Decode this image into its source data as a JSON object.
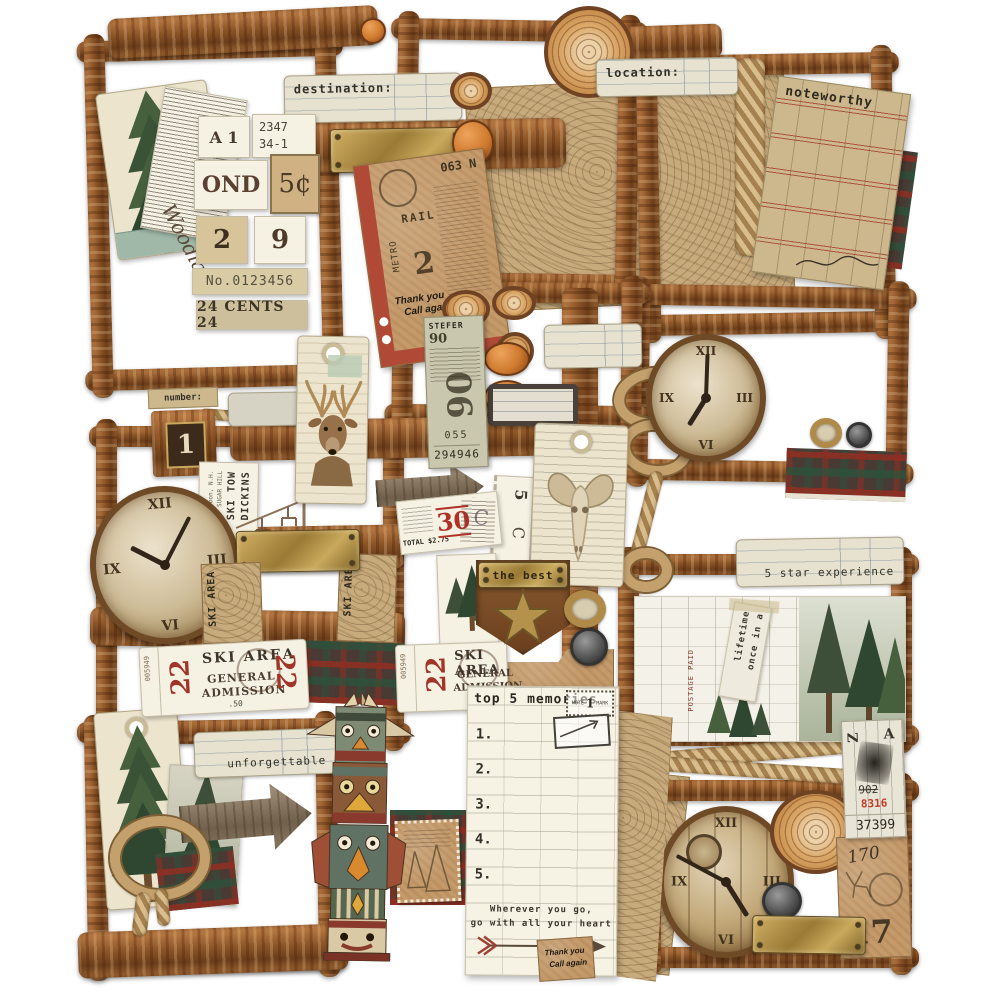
{
  "colors": {
    "wood": "#8a5328",
    "kraft": "#c49a6a",
    "brass": "#b08d3e",
    "accent_red": "#a83a28",
    "teal": "#5f7264",
    "cream": "#ece4cc"
  },
  "labels": {
    "destination": "destination:",
    "location": "location:",
    "number": "number:",
    "noteworthy": "noteworthy",
    "five_star": "5 star experience",
    "unforgettable": "unforgettable",
    "the_best": "the best",
    "once_line1": "once in a",
    "once_line2": "lifetime",
    "postage": "POSTAGE PAID",
    "block_numeral": "1",
    "script_word": "Woodland"
  },
  "stamps": {
    "a1": "A 1",
    "route_line1": "2347",
    "route_line2": "34-1",
    "ond": "OND",
    "five_cents": "5¢",
    "numeral_left": "2",
    "numeral_right": "9",
    "serial": "No.0123456",
    "cents": "24 CENTS 24"
  },
  "tickets": {
    "stefer": {
      "head": "STEFER",
      "sub": "90",
      "big": "90",
      "num": "055",
      "serial": "294946"
    },
    "rail": {
      "top": "063 N",
      "rail": "RAIL",
      "metro": "METRO",
      "big": "2",
      "thanks1": "Thank you",
      "thanks2": "Call again",
      "num": "033"
    },
    "red30": {
      "day": "30",
      "total": "TOTAL $2.75",
      "over": "C"
    },
    "strip5c": {
      "n": "5",
      "c": "C"
    },
    "ski": {
      "title": "SKI AREA",
      "big": "22",
      "line1": "GENERAL",
      "line2": "ADMISSION",
      "price": ".50",
      "serial": "005949"
    },
    "dickins": {
      "line1": "DICKINS",
      "line2": "SKI TOW",
      "line3": "SUGAR HILL",
      "line4": "Lisbon, N.H."
    },
    "ski_map": "SKI AREA",
    "za": {
      "z": "Z",
      "a": "A",
      "num": "902",
      "red": "8316",
      "serial": "37399"
    },
    "k17": {
      "script": "170",
      "big": "17"
    },
    "thanks1": "Thank you",
    "thanks2": "Call again"
  },
  "memo": {
    "title": "top 5 memories",
    "stamp_left": "NOTE",
    "stamp_num": "1",
    "stamp_right": "MARK",
    "rows": [
      "1.",
      "2.",
      "3.",
      "4.",
      "5."
    ],
    "quote1": "Wherever you go,",
    "quote2": "go with all your heart"
  },
  "clock": {
    "numerals": [
      "XII",
      "III",
      "VI",
      "IX"
    ]
  }
}
